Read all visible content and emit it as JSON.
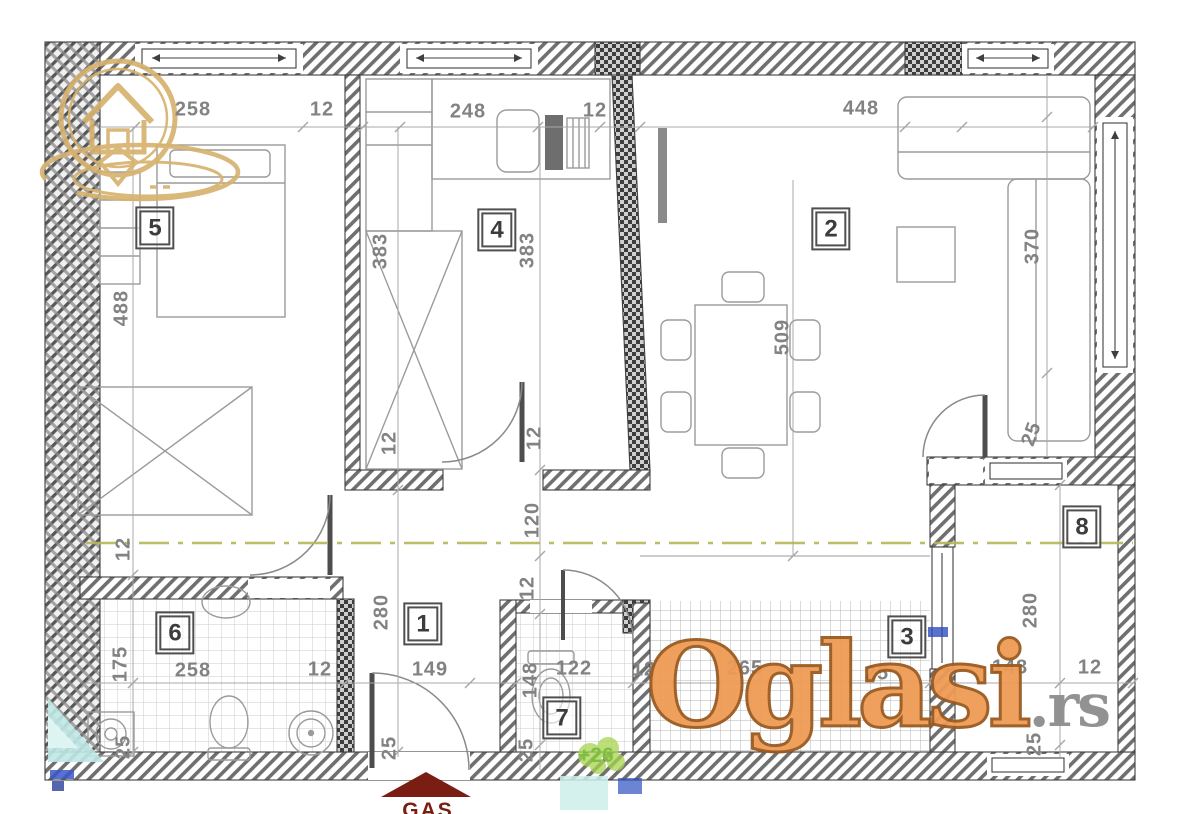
{
  "watermark": {
    "brand": "Oglasi",
    "tld": ".rs"
  },
  "logo": {
    "name": "house-pin-logo"
  },
  "colors": {
    "watermark_orange": "#ef9b55",
    "watermark_outline": "#9a5a1f",
    "watermark_gray": "#8d8d8d",
    "logo_gold": "#d6b26e",
    "centerline_olive": "#b6b655",
    "roof_red": "#7a1d12",
    "annotation_green": "#7cbf3f",
    "dim_gray": "#828282",
    "wall_gray": "#3f3f3f"
  },
  "room_labels": [
    {
      "number": "5",
      "x": 155,
      "y": 228
    },
    {
      "number": "4",
      "x": 497,
      "y": 230
    },
    {
      "number": "2",
      "x": 831,
      "y": 229
    },
    {
      "number": "1",
      "x": 423,
      "y": 624
    },
    {
      "number": "6",
      "x": 175,
      "y": 633
    },
    {
      "number": "7",
      "x": 562,
      "y": 718
    },
    {
      "number": "3",
      "x": 907,
      "y": 637
    },
    {
      "number": "8",
      "x": 1082,
      "y": 527
    }
  ],
  "dimension_labels": [
    {
      "text": "258",
      "x": 193,
      "y": 110,
      "rot": 0
    },
    {
      "text": "12",
      "x": 322,
      "y": 110,
      "rot": 0
    },
    {
      "text": "248",
      "x": 468,
      "y": 112,
      "rot": 0
    },
    {
      "text": "12",
      "x": 595,
      "y": 111,
      "rot": 0
    },
    {
      "text": "448",
      "x": 861,
      "y": 109,
      "rot": 0
    },
    {
      "text": "488",
      "x": 122,
      "y": 308,
      "rot": -90
    },
    {
      "text": "12",
      "x": 124,
      "y": 549,
      "rot": -90
    },
    {
      "text": "175",
      "x": 121,
      "y": 664,
      "rot": -90
    },
    {
      "text": "25",
      "x": 124,
      "y": 747,
      "rot": -90
    },
    {
      "text": "383",
      "x": 381,
      "y": 251,
      "rot": -90
    },
    {
      "text": "383",
      "x": 528,
      "y": 250,
      "rot": -90
    },
    {
      "text": "12",
      "x": 390,
      "y": 443,
      "rot": -90
    },
    {
      "text": "12",
      "x": 535,
      "y": 438,
      "rot": -90
    },
    {
      "text": "120",
      "x": 533,
      "y": 520,
      "rot": -90
    },
    {
      "text": "12",
      "x": 528,
      "y": 588,
      "rot": -90
    },
    {
      "text": "280",
      "x": 382,
      "y": 612,
      "rot": -90
    },
    {
      "text": "25",
      "x": 390,
      "y": 748,
      "rot": -90
    },
    {
      "text": "149",
      "x": 430,
      "y": 670,
      "rot": 0
    },
    {
      "text": "258",
      "x": 193,
      "y": 671,
      "rot": 0
    },
    {
      "text": "12",
      "x": 320,
      "y": 670,
      "rot": 0
    },
    {
      "text": "148",
      "x": 531,
      "y": 680,
      "rot": -90
    },
    {
      "text": "122",
      "x": 574,
      "y": 669,
      "rot": 0
    },
    {
      "text": "25",
      "x": 527,
      "y": 750,
      "rot": -90
    },
    {
      "text": "12",
      "x": 644,
      "y": 670,
      "rot": 0
    },
    {
      "text": "265",
      "x": 745,
      "y": 669,
      "rot": 0
    },
    {
      "text": "25",
      "x": 877,
      "y": 674,
      "rot": 0
    },
    {
      "text": "370",
      "x": 1033,
      "y": 246,
      "rot": -90
    },
    {
      "text": "509",
      "x": 783,
      "y": 337,
      "rot": -90
    },
    {
      "text": "25",
      "x": 1032,
      "y": 434,
      "rot": -70
    },
    {
      "text": "280",
      "x": 1031,
      "y": 610,
      "rot": -90
    },
    {
      "text": "148",
      "x": 1010,
      "y": 668,
      "rot": 0
    },
    {
      "text": "12",
      "x": 1090,
      "y": 668,
      "rot": 0
    },
    {
      "text": "25",
      "x": 1035,
      "y": 744,
      "rot": -90
    }
  ],
  "annotations": [
    {
      "text": "+26"
    }
  ],
  "entrance_label": {
    "text": "GAS"
  }
}
